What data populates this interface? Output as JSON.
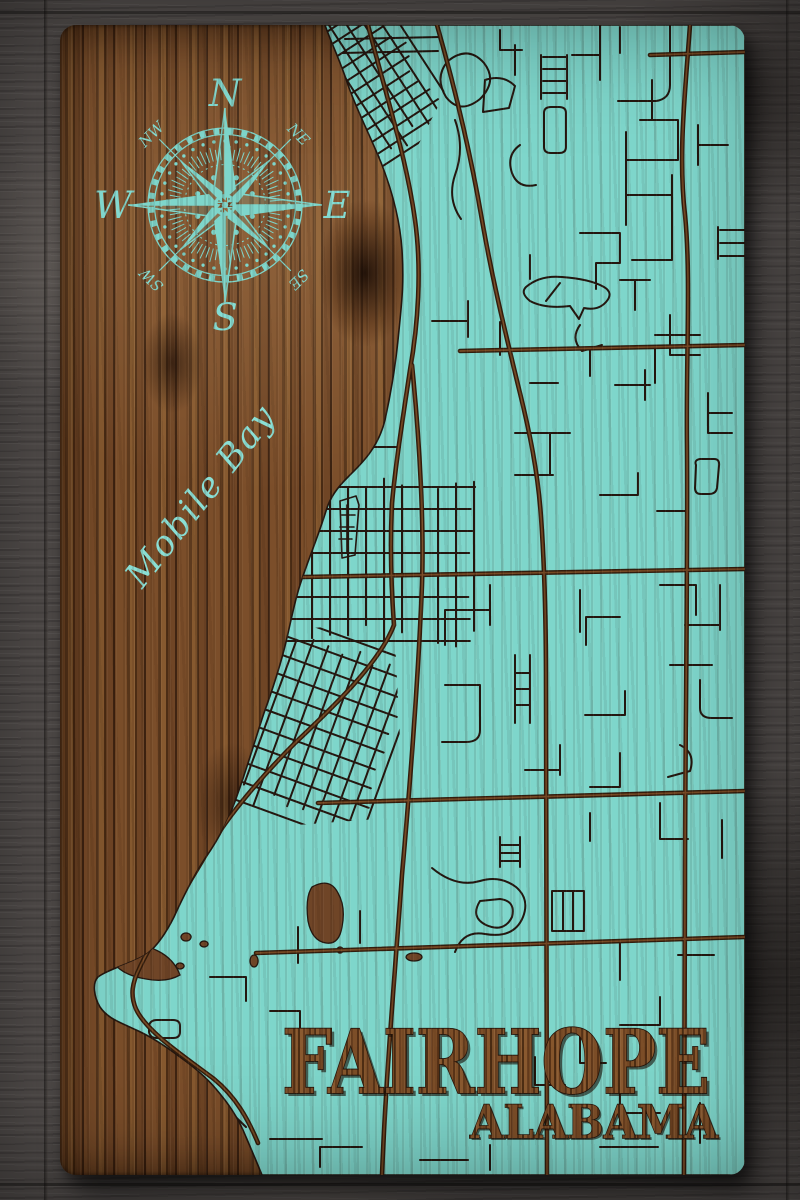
{
  "board": {
    "city_title": "FAIRHOPE",
    "state_title": "ALABAMA",
    "water_label": "Mobile Bay",
    "compass": {
      "cardinals": [
        "N",
        "E",
        "S",
        "W"
      ],
      "intercardinals": [
        "NW",
        "NE",
        "SE",
        "SW"
      ]
    }
  },
  "colors": {
    "map_paint_teal": "#7ed6cb",
    "engraved_line": "#241710",
    "burned_road_brown": "#3d2413",
    "board_wood_mid": "#6a4324",
    "board_wood_light": "#86592f",
    "board_wood_dark": "#3f2412",
    "background_planks_gray": "#575250",
    "title_wood_brown": "#7a4c26",
    "label_teal": "#84dcd2"
  }
}
